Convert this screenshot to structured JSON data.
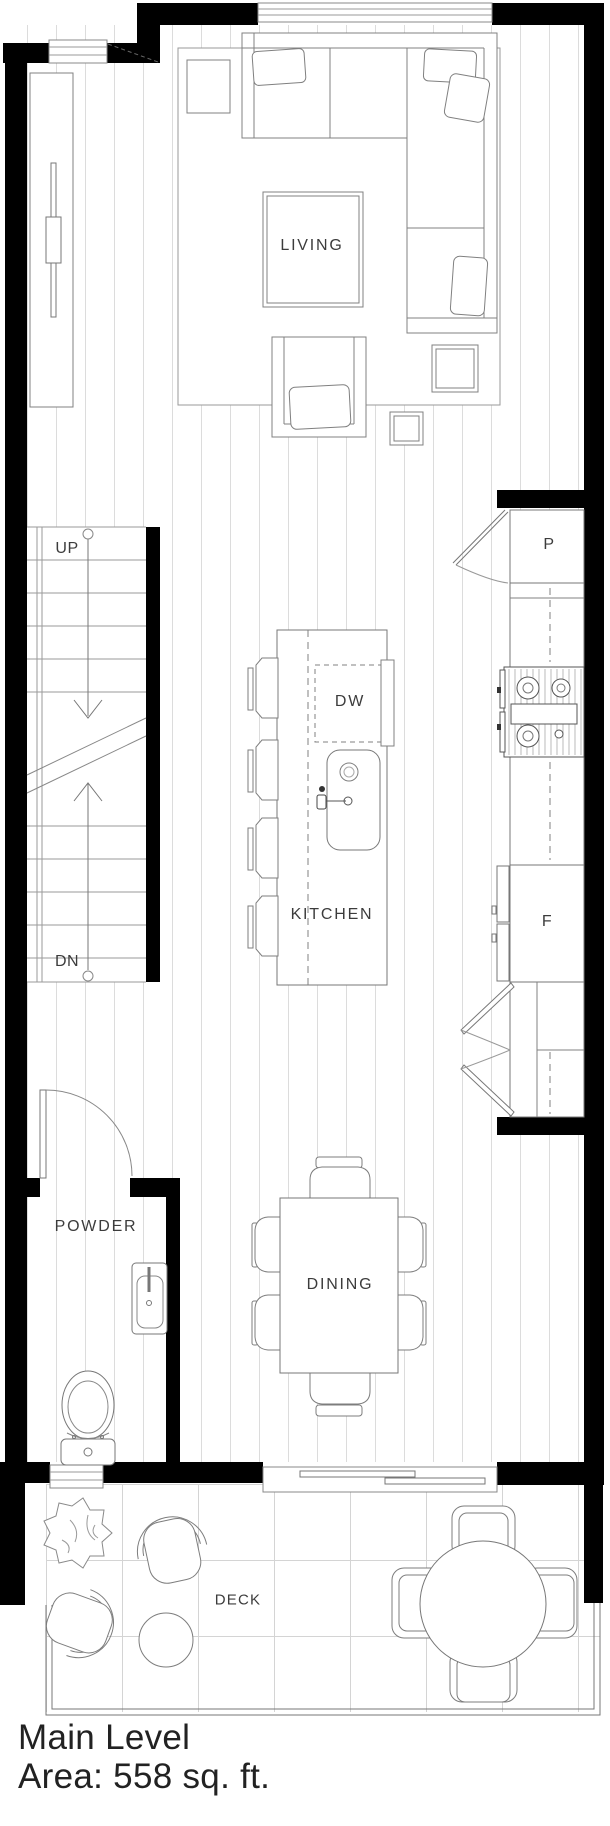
{
  "labels": {
    "living": "LIVING",
    "kitchen": "KITCHEN",
    "dining": "DINING",
    "powder": "POWDER",
    "deck": "DECK",
    "dishwasher": "DW",
    "pantry": "P",
    "fridge": "F",
    "up": "UP",
    "down": "DN"
  },
  "title": {
    "name": "Main Level",
    "area": "Area: 558 sq. ft."
  },
  "colors": {
    "wall": "#000000",
    "furniture_line": "#808080",
    "floor_plank_line": "#dcdcdc",
    "deck_grid_line": "#d4d4d4",
    "label_text": "#3c3c3c",
    "caption_text": "#222222"
  }
}
